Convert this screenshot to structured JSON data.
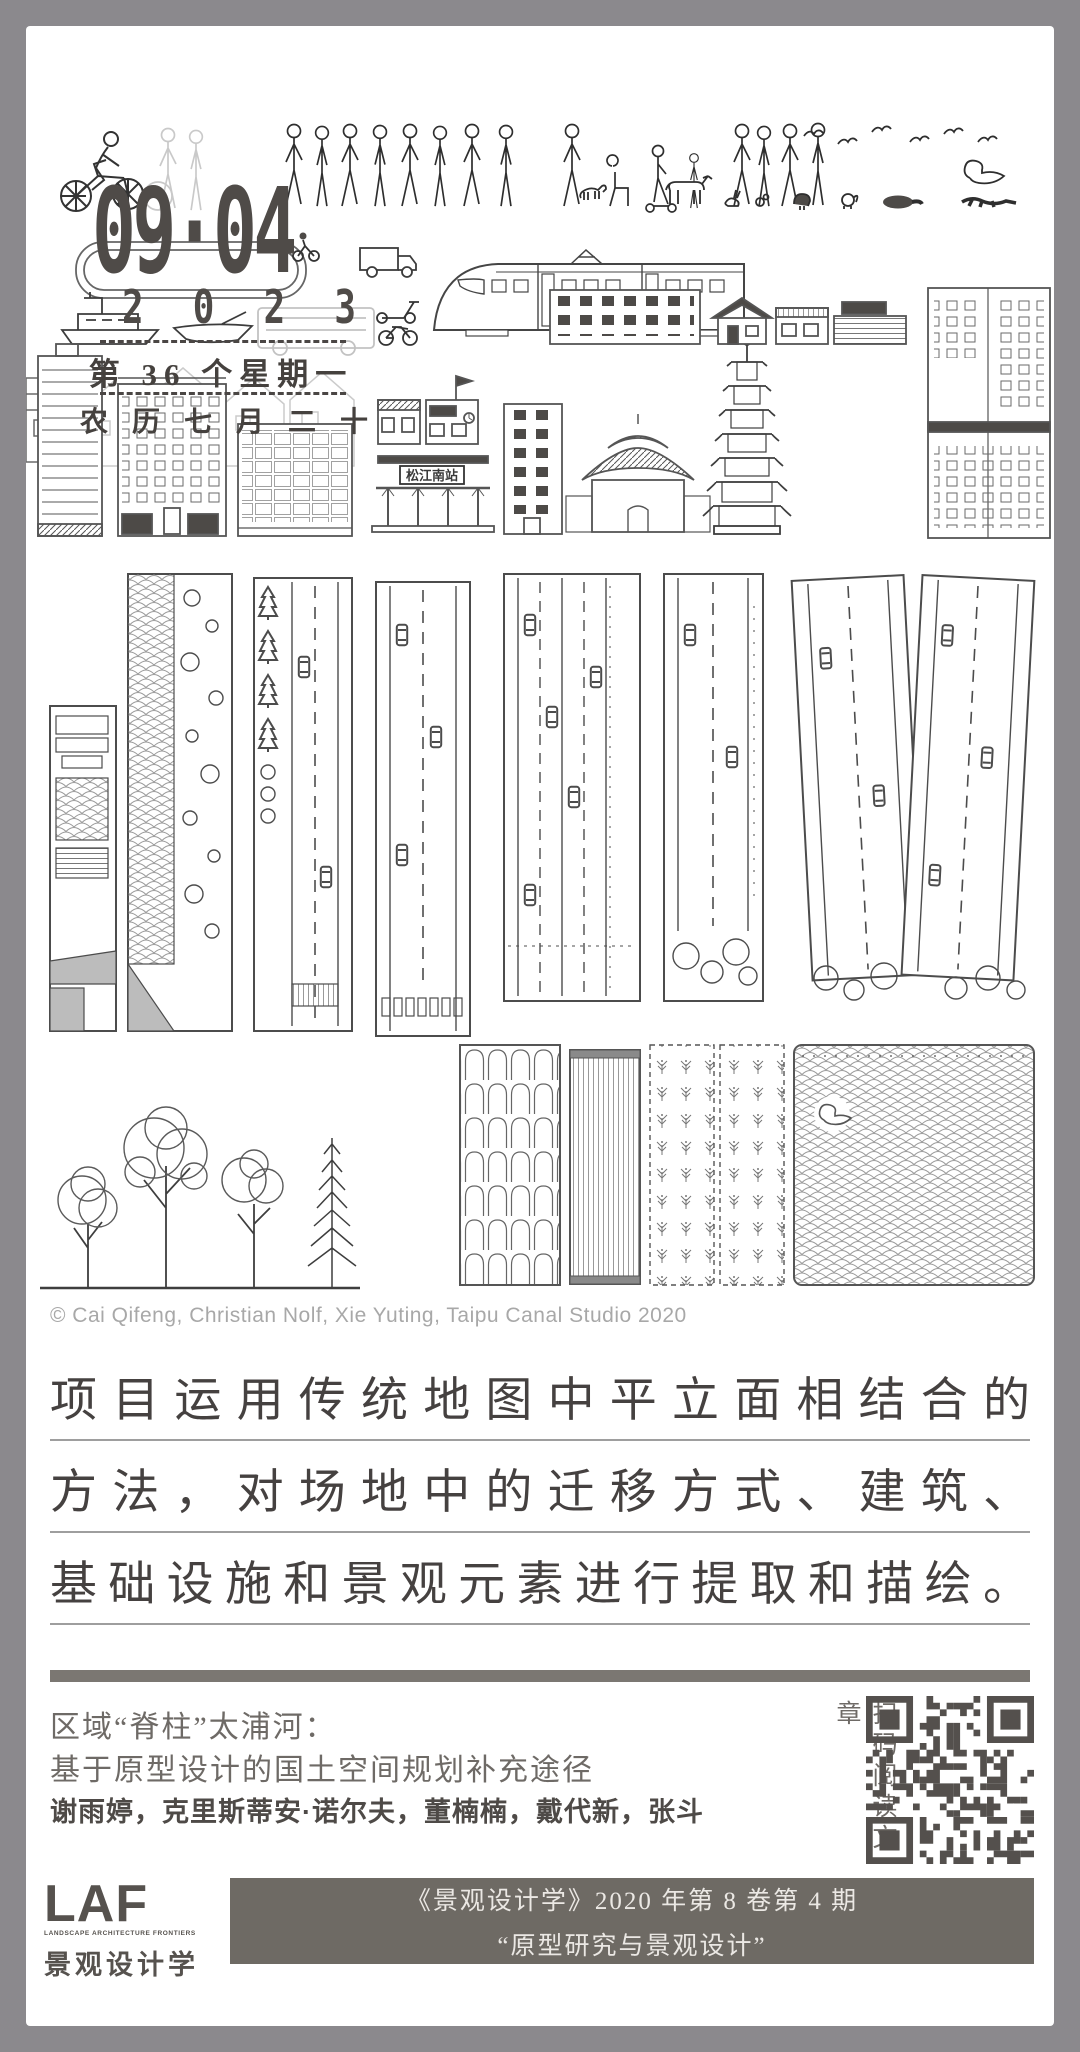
{
  "date_card": {
    "date": "09·04",
    "year_digits": [
      "2",
      "0",
      "2",
      "3"
    ],
    "week_label": "第 36 个星期一",
    "lunar_label": "农历七月二十"
  },
  "illustration": {
    "station_sign": "松江南站",
    "credit": "© Cai Qifeng, Christian Nolf, Xie Yuting, Taipu Canal Studio 2020"
  },
  "quote": {
    "lines": [
      "项目运用传统地图中平立面相结合的",
      "方法，对场地中的迁移方式、建筑、",
      "基础设施和景观元素进行提取和描绘。"
    ]
  },
  "article": {
    "title_line1": "区域“脊柱”太浦河：",
    "title_line2": "基于原型设计的国土空间规划补充途径",
    "authors": "谢雨婷，克里斯蒂安·诺尔夫，董楠楠，戴代新，张斗",
    "qr_caption": "扫码阅读文章"
  },
  "footer": {
    "logo": {
      "acronym": "LAF",
      "tagline": "LANDSCAPE ARCHITECTURE FRONTIERS",
      "cn_name": "景观设计学"
    },
    "journal_line": "《景观设计学》2020 年第 8 卷第 4 期",
    "issue_theme": "“原型研究与景观设计”"
  },
  "colors": {
    "frame": "#8b898d",
    "ink": "#474340",
    "muted_gray": "#a8a8a8",
    "footer_bar": "#6e6a64",
    "divider_bar": "#7b7772",
    "qr": "#54504d"
  }
}
